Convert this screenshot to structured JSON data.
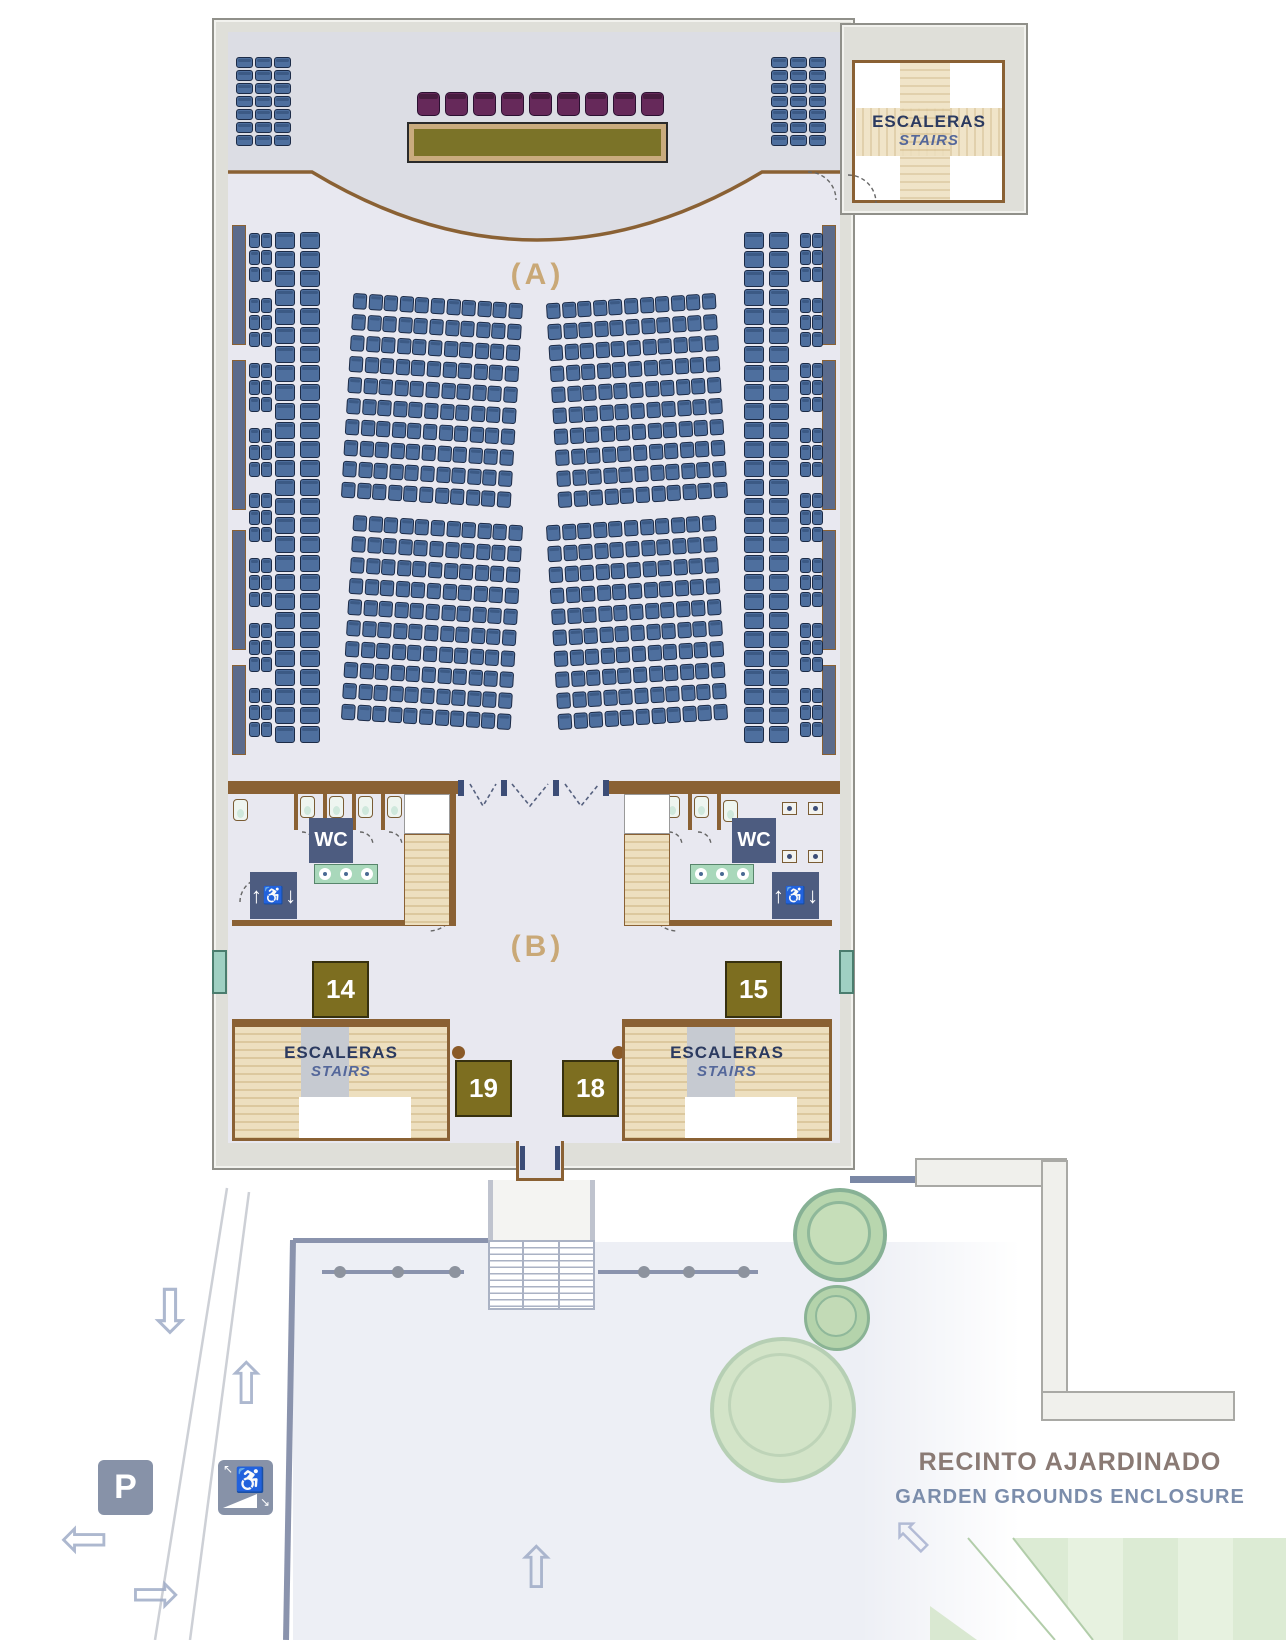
{
  "labels": {
    "zone_a": "(A)",
    "zone_b": "(B)",
    "stairs_es": "ESCALERAS",
    "stairs_en": "STAIRS",
    "wc": "WC",
    "parking": "P",
    "garden_line1": "RECINTO AJARDINADO",
    "garden_line2": "GARDEN GROUNDS ENCLOSURE"
  },
  "rooms": {
    "n14": "14",
    "n15": "15",
    "n18": "18",
    "n19": "19"
  },
  "icons": {
    "arrow_down": "⇩",
    "arrow_up": "⇧",
    "arrow_left": "⇦",
    "arrow_right": "⇨",
    "arrow_upleft": "⇧",
    "wheelchair": "♿",
    "lift_up": "↑",
    "lift_down": "↓",
    "ramp_in": "↖",
    "ramp_out": "↘"
  },
  "colors": {
    "seat": "#4e6f9e",
    "seat_border": "#1c2b47",
    "stage_seat": "#66295a",
    "table": "#7b7328",
    "wall_wood": "#8a6134",
    "wall_gray": "#dfdfd9",
    "floor": "#e8e8f0",
    "stage_floor": "#dcdde4",
    "badge_olive": "#7d6e20",
    "badge_navy": "#4d5c80",
    "plaza": "#edeff5",
    "tree": "#b8d6ae",
    "garden_green": "#dcebd4",
    "accent_tan": "#c9a877",
    "teal_window": "#9fd0c2"
  },
  "seating": {
    "blocks": [
      {
        "name": "corner-left",
        "x": 236,
        "y": 57,
        "cols": 3,
        "rows": 7,
        "w": 17,
        "h": 11,
        "gx": 2,
        "gy": 2
      },
      {
        "name": "corner-right",
        "x": 771,
        "y": 57,
        "cols": 3,
        "rows": 7,
        "w": 17,
        "h": 11,
        "gx": 2,
        "gy": 2
      },
      {
        "name": "left-wall-pairs",
        "x": 249,
        "y": 233,
        "cols": 2,
        "rows": 3,
        "w": 11,
        "h": 15,
        "gx": 1,
        "gy": 2,
        "repeat": 8,
        "stepY": 65
      },
      {
        "name": "right-wall-pairs",
        "x": 800,
        "y": 233,
        "cols": 2,
        "rows": 3,
        "w": 11,
        "h": 15,
        "gx": 1,
        "gy": 2,
        "repeat": 8,
        "stepY": 65
      },
      {
        "name": "left-col-a",
        "x": 275,
        "y": 232,
        "cols": 1,
        "rows": 27,
        "w": 20,
        "h": 17,
        "gx": 0,
        "gy": 2
      },
      {
        "name": "left-col-b",
        "x": 300,
        "y": 232,
        "cols": 1,
        "rows": 27,
        "w": 20,
        "h": 17,
        "gx": 0,
        "gy": 2
      },
      {
        "name": "right-col-b",
        "x": 744,
        "y": 232,
        "cols": 1,
        "rows": 27,
        "w": 20,
        "h": 17,
        "gx": 0,
        "gy": 2
      },
      {
        "name": "right-col-a",
        "x": 769,
        "y": 232,
        "cols": 1,
        "rows": 27,
        "w": 20,
        "h": 17,
        "gx": 0,
        "gy": 2
      },
      {
        "name": "center-upper-left",
        "x": 347,
        "y": 298,
        "cols": 11,
        "rows": 10,
        "w": 14,
        "h": 16,
        "gx": 1.6,
        "gy": 5,
        "rot": 3.5
      },
      {
        "name": "center-upper-right",
        "x": 552,
        "y": 298,
        "cols": 11,
        "rows": 10,
        "w": 14,
        "h": 16,
        "gx": 1.6,
        "gy": 5,
        "rot": -3.5
      },
      {
        "name": "center-lower-left",
        "x": 347,
        "y": 520,
        "cols": 11,
        "rows": 10,
        "w": 14,
        "h": 16,
        "gx": 1.6,
        "gy": 5,
        "rot": 3.5
      },
      {
        "name": "center-lower-right",
        "x": 552,
        "y": 520,
        "cols": 11,
        "rows": 10,
        "w": 14,
        "h": 16,
        "gx": 1.6,
        "gy": 5,
        "rot": -3.5
      },
      {
        "name": "stage-chairs",
        "x": 417,
        "y": 92,
        "cols": 9,
        "rows": 1,
        "w": 23,
        "h": 24,
        "gx": 5,
        "gy": 0,
        "style": "purple"
      }
    ]
  }
}
